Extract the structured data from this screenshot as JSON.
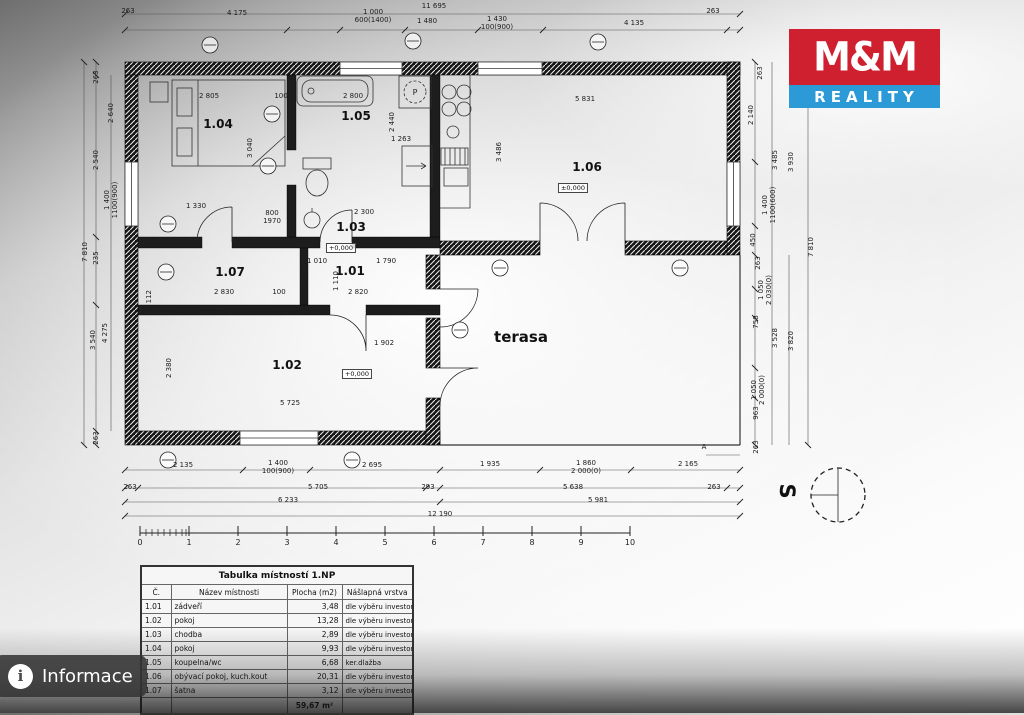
{
  "viewer": {
    "info_label": "Informace",
    "info_icon": "i"
  },
  "logo": {
    "line1": "M&M",
    "line2": "REALITY",
    "red": "#cf2030",
    "blue": "#2b9ad6"
  },
  "north": {
    "letter": "S"
  },
  "plan": {
    "rooms": {
      "r101": "1.01",
      "r102": "1.02",
      "r103": "1.03",
      "r104": "1.04",
      "r105": "1.05",
      "r106": "1.06",
      "r107": "1.07",
      "terasa": "terasa"
    },
    "elev": {
      "e1": "+0,000",
      "e2": "+0,000",
      "e3": "±0,000"
    },
    "washer_label": "P",
    "marker_a": "A",
    "dims_top": [
      "263",
      "4 175",
      "1 000\n600(1400)",
      "11 695",
      "1 480",
      "1 430\n100(900)",
      "4 135",
      "263"
    ],
    "dims_bottom": [
      "2 135",
      "1 400\n100(900)",
      "2 695",
      "1 935",
      "1 860\n2 000(0)",
      "2 165",
      "263",
      "5 705",
      "293",
      "5 638",
      "263",
      "6 233",
      "5 981",
      "12 190"
    ],
    "dims_left": [
      "263",
      "2 640",
      "2 540",
      "1 400\n1100(900)",
      "235",
      "7 810",
      "3 540",
      "4 275",
      "263"
    ],
    "dims_right": [
      "263",
      "2 140",
      "3 485",
      "3 930",
      "1 400\n1100(600)",
      "450",
      "7 810",
      "263",
      "1 050\n2 030(0)",
      "758",
      "3 528",
      "3 820",
      "1 050\n2 000(0)",
      "963",
      "263"
    ],
    "dims_inner": [
      "2 805",
      "100",
      "2 800",
      "3 040",
      "2 440",
      "1 263",
      "5 831",
      "3 486",
      "1 330",
      "2 300",
      "1 010",
      "1 790",
      "2 830",
      "100",
      "2 820",
      "5 725",
      "2 380",
      "1 902",
      "1 112",
      "1 110",
      "800\n1970"
    ],
    "scale": [
      "0",
      "1",
      "2",
      "3",
      "4",
      "5",
      "6",
      "7",
      "8",
      "9",
      "10"
    ]
  },
  "table": {
    "title": "Tabulka místností 1.NP",
    "headers": [
      "Č.",
      "Název místnosti",
      "Plocha (m2)",
      "Nášlapná vrstva"
    ],
    "rows": [
      {
        "no": "1.01",
        "name": "zádveří",
        "area": "3,48",
        "layer": "dle výběru investora"
      },
      {
        "no": "1.02",
        "name": "pokoj",
        "area": "13,28",
        "layer": "dle výběru investora"
      },
      {
        "no": "1.03",
        "name": "chodba",
        "area": "2,89",
        "layer": "dle výběru investora"
      },
      {
        "no": "1.04",
        "name": "pokoj",
        "area": "9,93",
        "layer": "dle výběru investora"
      },
      {
        "no": "1.05",
        "name": "koupelna/wc",
        "area": "6,68",
        "layer": "ker.dlažba"
      },
      {
        "no": "1.06",
        "name": "obývací pokoj, kuch.kout",
        "area": "20,31",
        "layer": "dle výběru investora"
      },
      {
        "no": "1.07",
        "name": "šatna",
        "area": "3,12",
        "layer": "dle výběru investora"
      }
    ],
    "total": "59,67 m²"
  }
}
